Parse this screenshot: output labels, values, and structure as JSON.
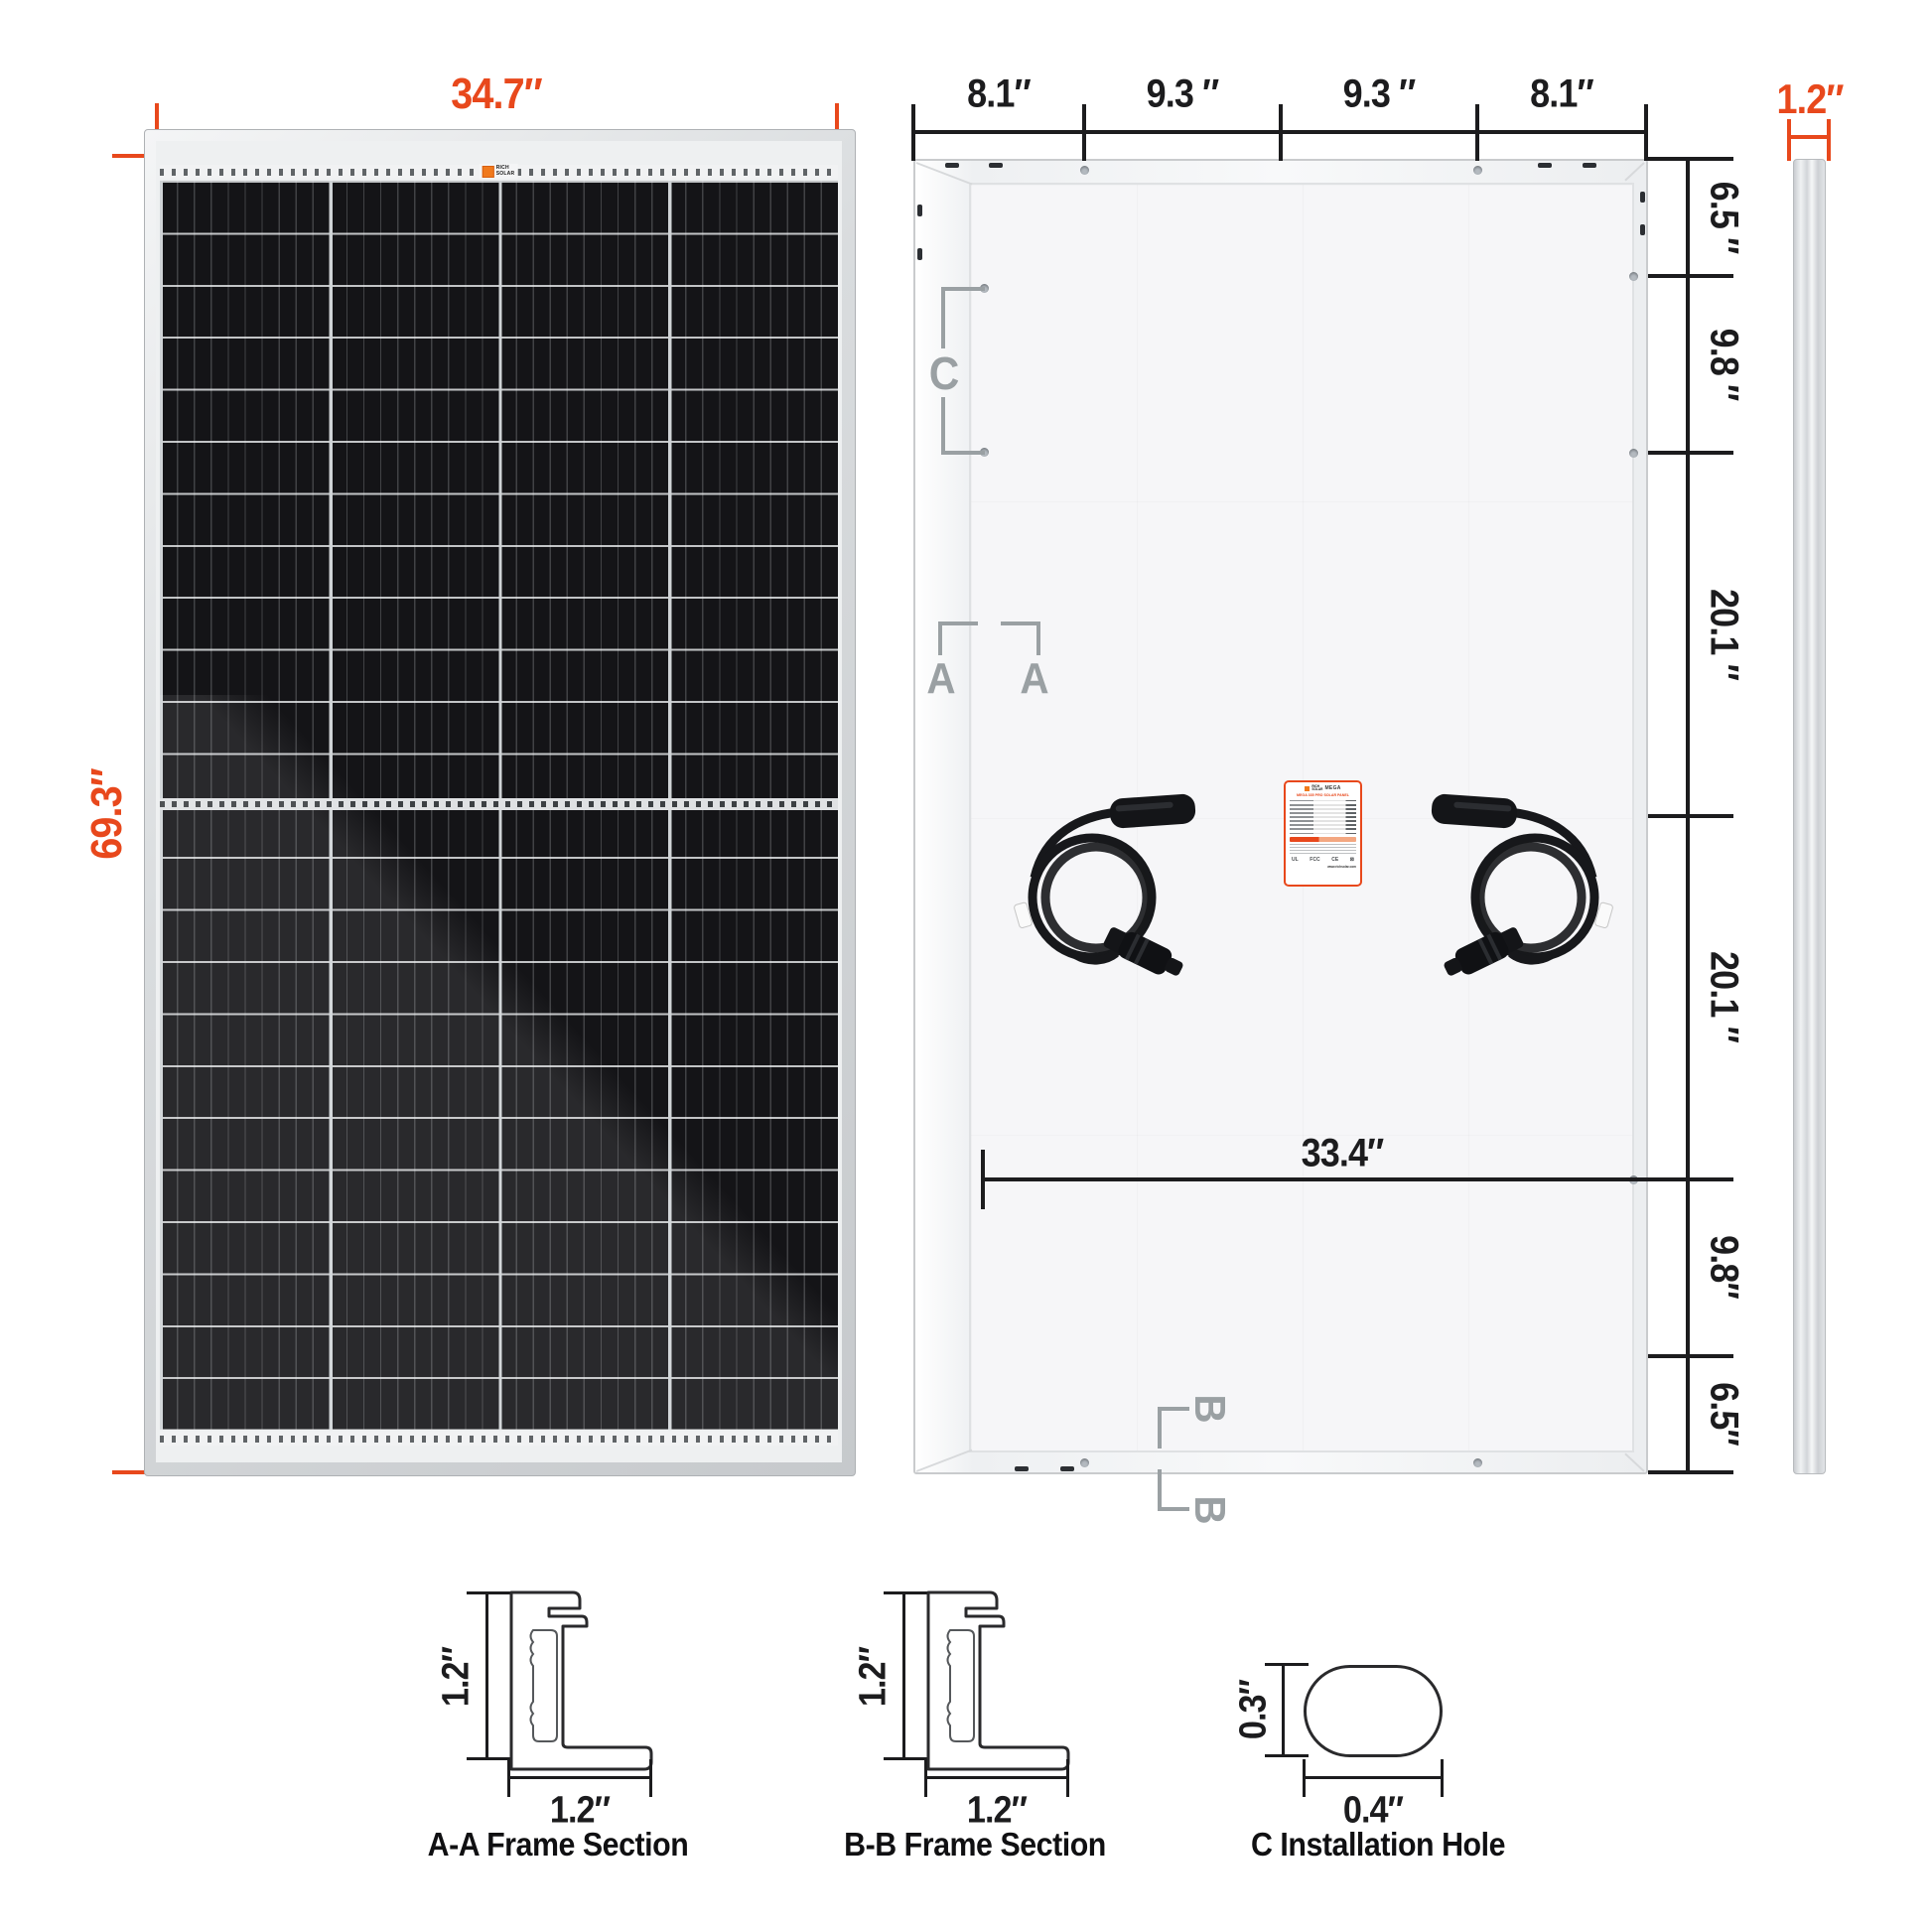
{
  "colors": {
    "accent": "#E8481C",
    "dim": "#1c1c1e",
    "marker": "#9aa0a3"
  },
  "front_view": {
    "width_dim": "34.7″",
    "height_dim": "69.3″",
    "logo_line1": "RICH",
    "logo_line2": "SOLAR"
  },
  "back_view": {
    "top_dims": [
      "8.1″",
      "9.3 ″",
      "9.3 ″",
      "8.1″"
    ],
    "right_dims": [
      "6.5 ″",
      "9.8 ″",
      "20.1 ″",
      "20.1 ″",
      "9.8″",
      "6.5″"
    ],
    "inner_width_dim": "33.4″",
    "marker_c": "C",
    "marker_a": "A",
    "marker_b": "B",
    "spec_label": {
      "brand_line1": "RICH",
      "brand_line2": "SOLAR",
      "series": "MEGA",
      "title": "MEGA 335 PRO SOLAR PANEL",
      "cert_1": "UL",
      "cert_2": "FCC",
      "cert_3": "CE",
      "website": "www.richsolar.com"
    }
  },
  "side_view": {
    "thickness_dim": "1.2″"
  },
  "details": {
    "aa": {
      "height_dim": "1.2″",
      "width_dim": "1.2″",
      "caption": "A-A Frame Section"
    },
    "bb": {
      "height_dim": "1.2″",
      "width_dim": "1.2″",
      "caption": "B-B Frame Section"
    },
    "c": {
      "height_dim": "0.3″",
      "width_dim": "0.4″",
      "caption": "C Installation Hole"
    }
  }
}
